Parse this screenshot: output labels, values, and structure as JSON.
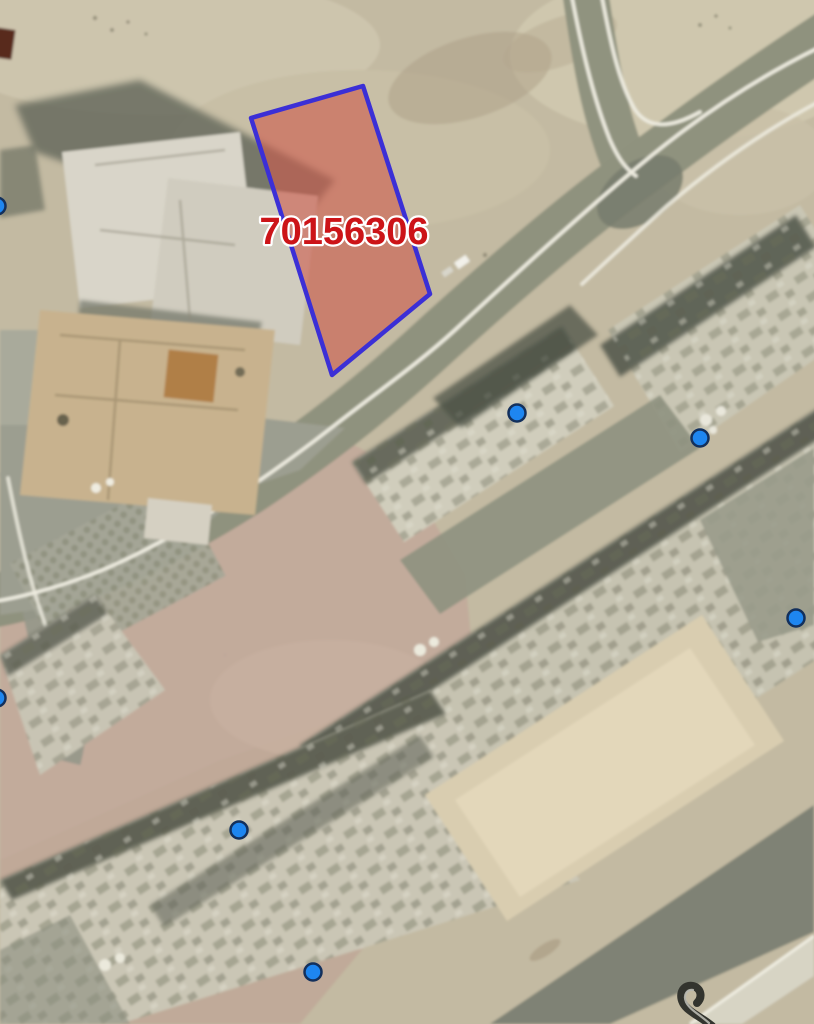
{
  "map": {
    "parcel": {
      "id": "70156306",
      "outline_color": "#3b2fd6",
      "fill_color": "rgba(205,92,78,0.62)",
      "polygon": [
        [
          363,
          86
        ],
        [
          430,
          294
        ],
        [
          332,
          375
        ],
        [
          251,
          118
        ]
      ],
      "label": {
        "text": "70156306",
        "color": "#cc1418",
        "halo_color": "#ffffff",
        "x": 344,
        "y": 232,
        "font_size": 38
      }
    },
    "markers": {
      "fill_color": "#1e86f0",
      "border_color": "#13305c",
      "radius": 8.5,
      "border_width": 2.5,
      "points": [
        [
          -3,
          206
        ],
        [
          517,
          413
        ],
        [
          700,
          438
        ],
        [
          796,
          618
        ],
        [
          -3,
          698
        ],
        [
          239,
          830
        ],
        [
          313,
          972
        ]
      ]
    }
  }
}
